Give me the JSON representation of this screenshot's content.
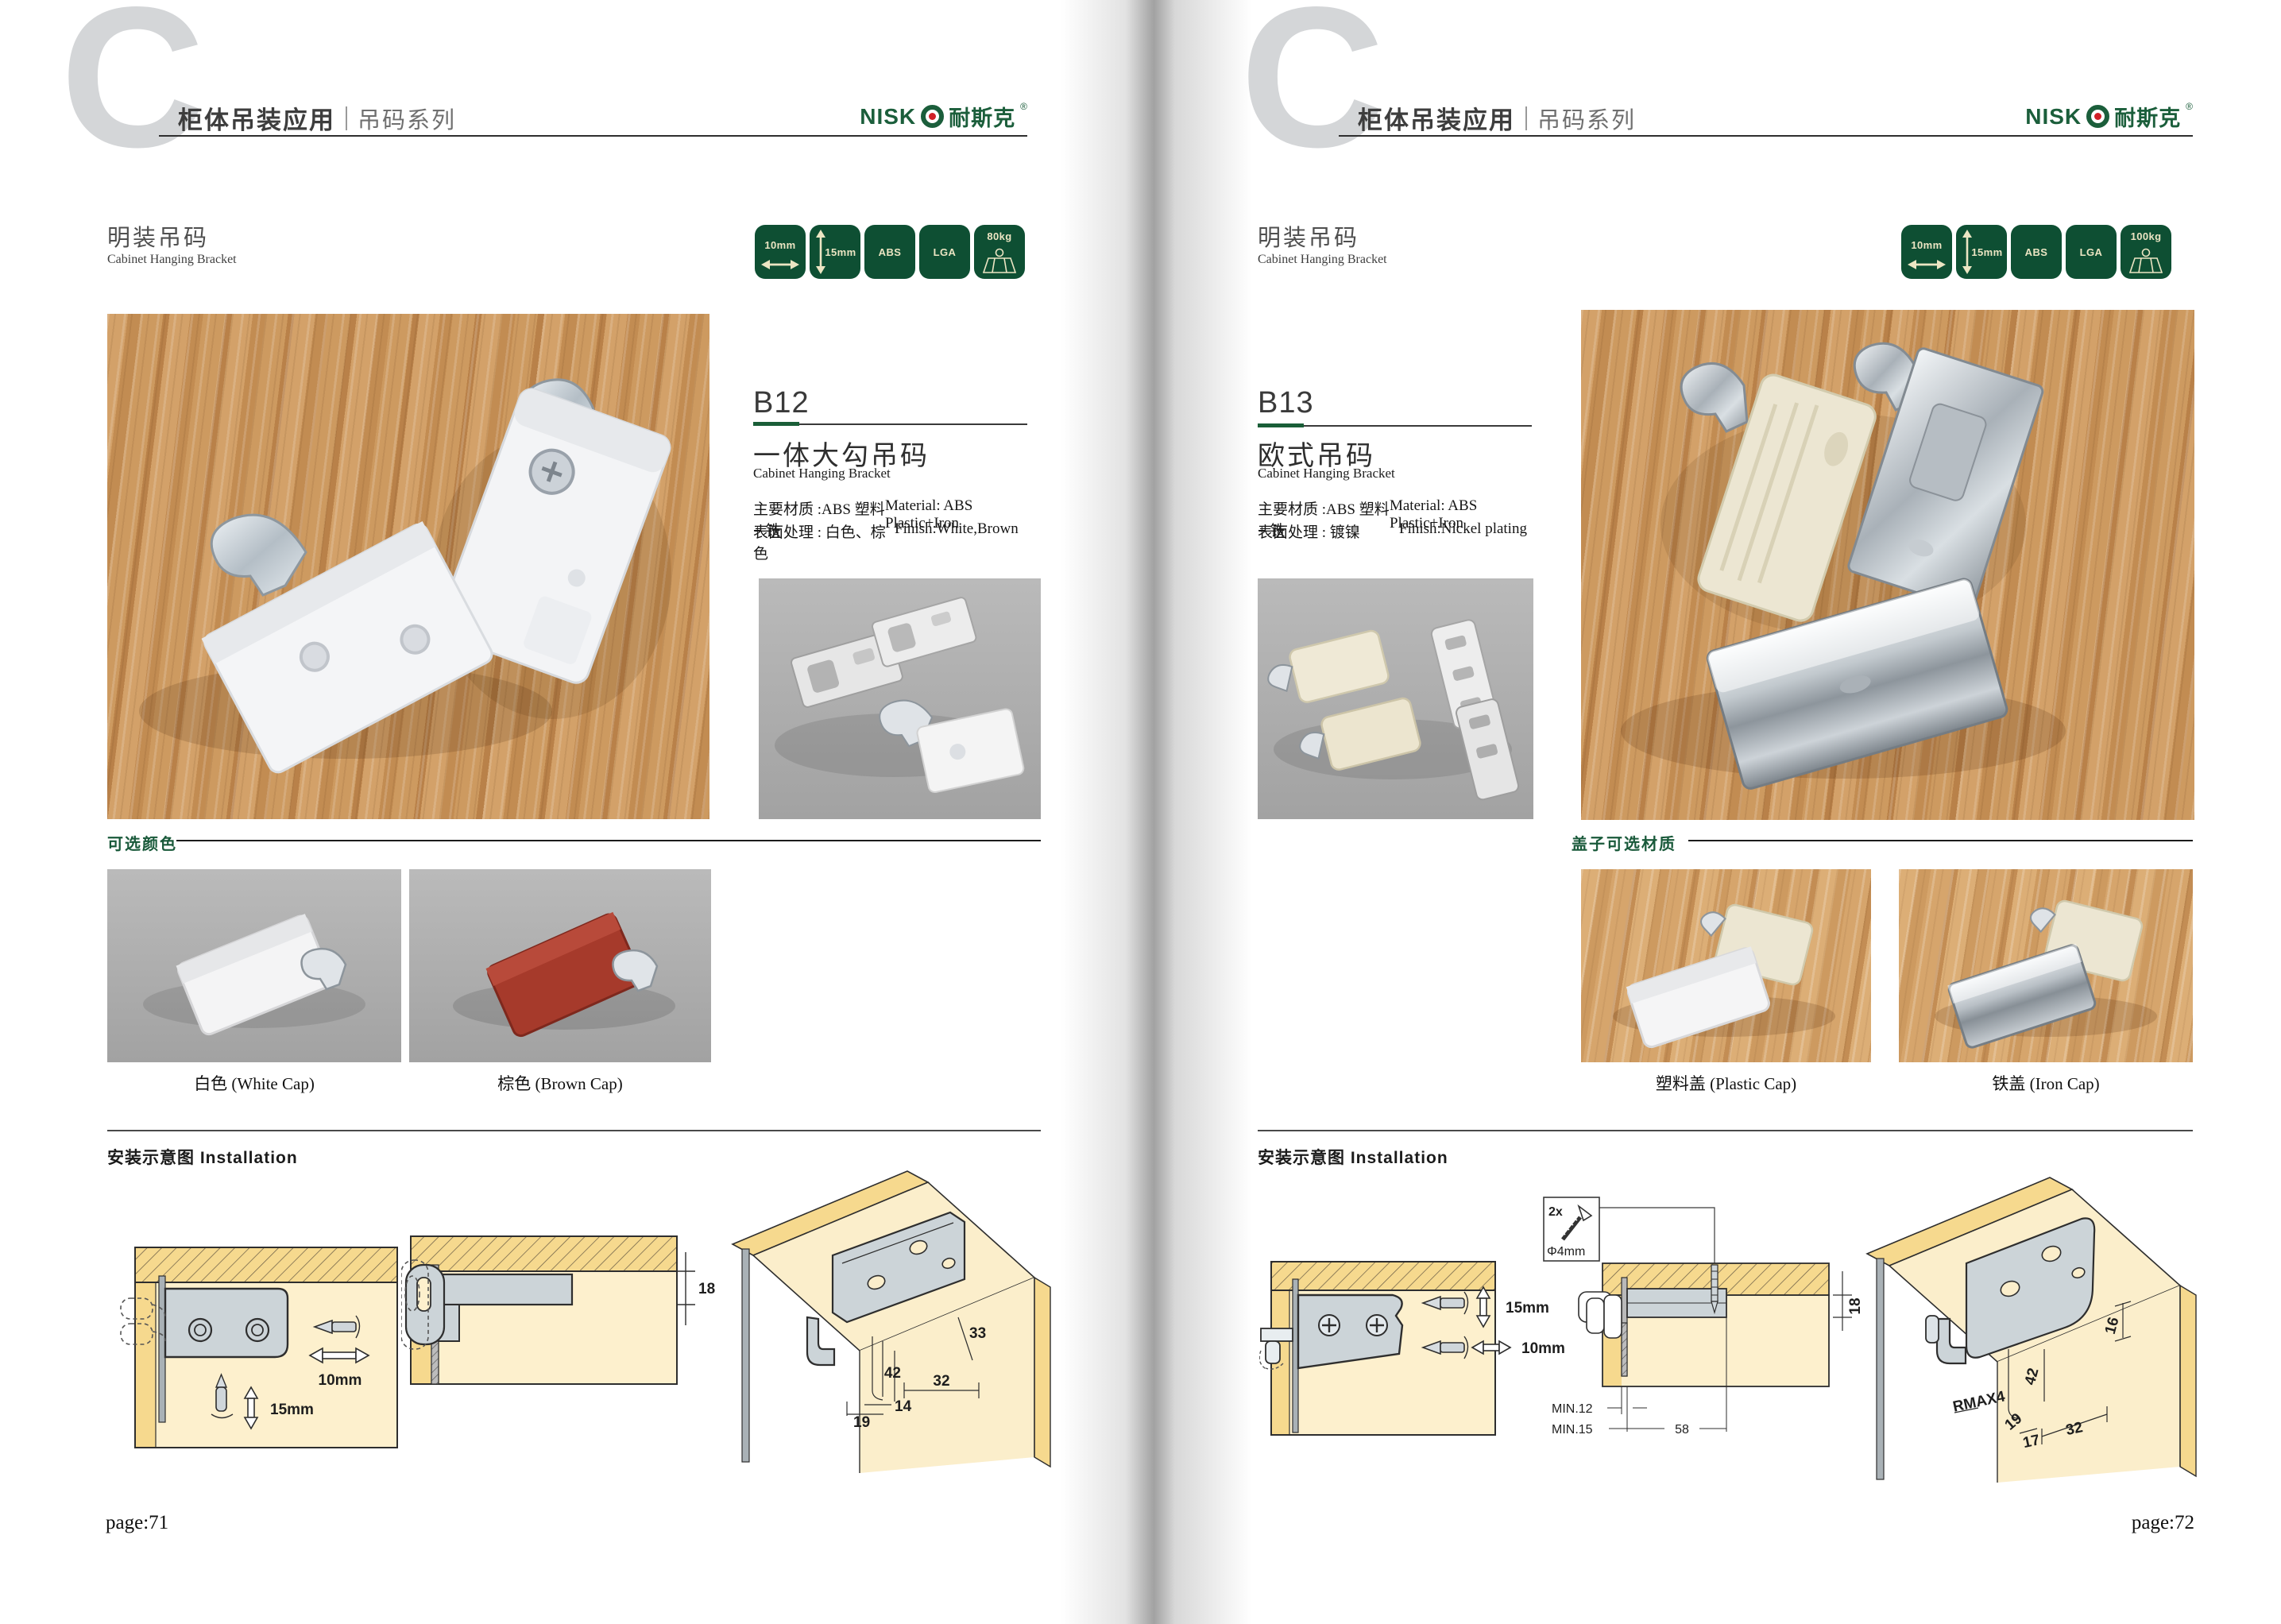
{
  "brand": {
    "logo_latin_prefix": "NISK",
    "logo_cjk": "耐斯克",
    "logo_reg": "®",
    "green": "#1b5e3b",
    "red": "#d01f26"
  },
  "header": {
    "chapter_letter": "C",
    "title_cn": "柜体吊装应用",
    "series_cn": "吊码系列"
  },
  "pages": {
    "left": {
      "section_title_cn": "明装吊码",
      "section_title_en": "Cabinet Hanging Bracket",
      "badges": [
        {
          "label": "10mm",
          "icon": "width-arrow"
        },
        {
          "label": "15mm",
          "icon": "height-arrow"
        },
        {
          "label": "ABS",
          "icon": "none"
        },
        {
          "label": "LGA",
          "icon": "none"
        },
        {
          "label": "80kg",
          "icon": "load-capacity"
        }
      ],
      "product": {
        "code": "B12",
        "name_cn": "一体大勾吊码",
        "name_en": "Cabinet Hanging Bracket",
        "material_cn": "主要材质 :ABS 塑料 + 铁",
        "material_en": "Material: ABS Plastic+Iron",
        "finish_cn": "表面处理 : 白色、棕色",
        "finish_en": "Finish:White,Brown"
      },
      "options": {
        "heading_cn": "可选颜色",
        "captions": [
          "白色 (White Cap)",
          "棕色 (Brown Cap)"
        ]
      },
      "installation": {
        "heading": "安装示意图 Installation",
        "diagram1": {
          "width_adjust": "10mm",
          "height_adjust": "15mm"
        },
        "diagram2": {
          "panel_thickness": "18"
        },
        "diagram3": {
          "dim_33": "33",
          "dim_42": "42",
          "dim_32": "32",
          "dim_14": "14",
          "dim_19": "19"
        }
      },
      "page_label": "page:71"
    },
    "right": {
      "section_title_cn": "明装吊码",
      "section_title_en": "Cabinet Hanging Bracket",
      "badges": [
        {
          "label": "10mm",
          "icon": "width-arrow"
        },
        {
          "label": "15mm",
          "icon": "height-arrow"
        },
        {
          "label": "ABS",
          "icon": "none"
        },
        {
          "label": "LGA",
          "icon": "none"
        },
        {
          "label": "100kg",
          "icon": "load-capacity"
        }
      ],
      "product": {
        "code": "B13",
        "name_cn": "欧式吊码",
        "name_en": "Cabinet Hanging Bracket",
        "material_cn": "主要材质 :ABS 塑料 + 铁",
        "material_en": "Material: ABS Plastic+Iron",
        "finish_cn": "表面处理 : 镀镍",
        "finish_en": "Finish:Nickel plating"
      },
      "options": {
        "heading_cn": "盖子可选材质",
        "captions": [
          "塑料盖 (Plastic Cap)",
          "铁盖 (Iron Cap)"
        ]
      },
      "installation": {
        "heading": "安装示意图 Installation",
        "diagram1": {
          "height_adjust": "15mm",
          "width_adjust": "10mm"
        },
        "diagram2": {
          "screw_qty": "2x",
          "screw_dia": "Φ4mm",
          "panel_thickness": "18",
          "min1": "MIN.12",
          "min2": "MIN.15",
          "span": "58"
        },
        "diagram3": {
          "dim_16": "16",
          "dim_42": "42",
          "dim_rmax": "RMAX4",
          "dim_19": "19",
          "dim_17": "17",
          "dim_32": "32"
        }
      },
      "page_label": "page:72"
    }
  }
}
